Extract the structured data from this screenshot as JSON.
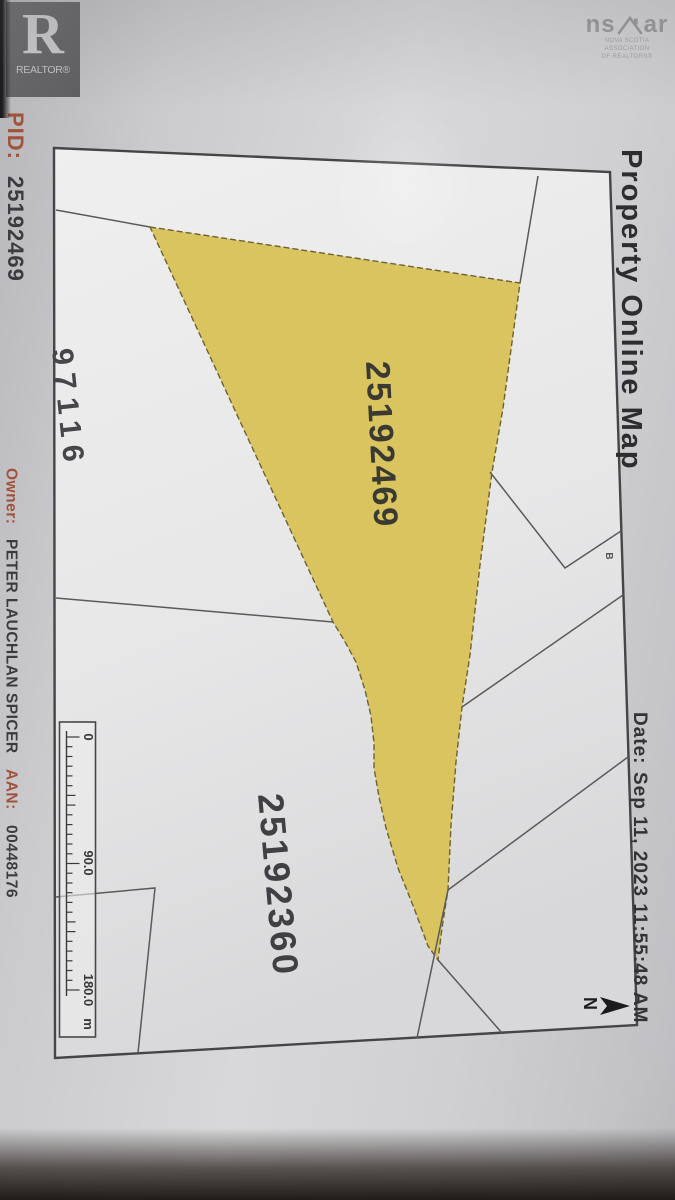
{
  "branding": {
    "realtor_symbol": "R",
    "realtor_wordmark": "REALTOR®",
    "nsar_wordmark_left": "ns",
    "nsar_wordmark_right": "ar",
    "nsar_tagline_line1": "NOVA SCOTIA ASSOCIATION",
    "nsar_tagline_line2": "OF REALTORS®"
  },
  "left_margin": {
    "pid_label": "PID:",
    "pid_value": "25192469",
    "owner_label": "Owner:",
    "owner_value": "PETER LAUCHLAN SPICER",
    "aan_label": "AAN:",
    "aan_value": "00448176",
    "label_color": "#a0523c"
  },
  "right_margin": {
    "title": "Property Online Map",
    "date_label": "Date:",
    "date_value": "Sep 11, 2023 11:55:48 AM"
  },
  "map": {
    "highlight_color": "#d9c45f",
    "highlighted_parcel_pid": "25192469",
    "south_parcel_pid": "25192360",
    "west_parcel_pid_partial": "97116",
    "corner_label": "B",
    "north_label": "N",
    "scale": {
      "start": "0",
      "middle": "90.0",
      "end": "180.0",
      "unit": "m"
    }
  }
}
